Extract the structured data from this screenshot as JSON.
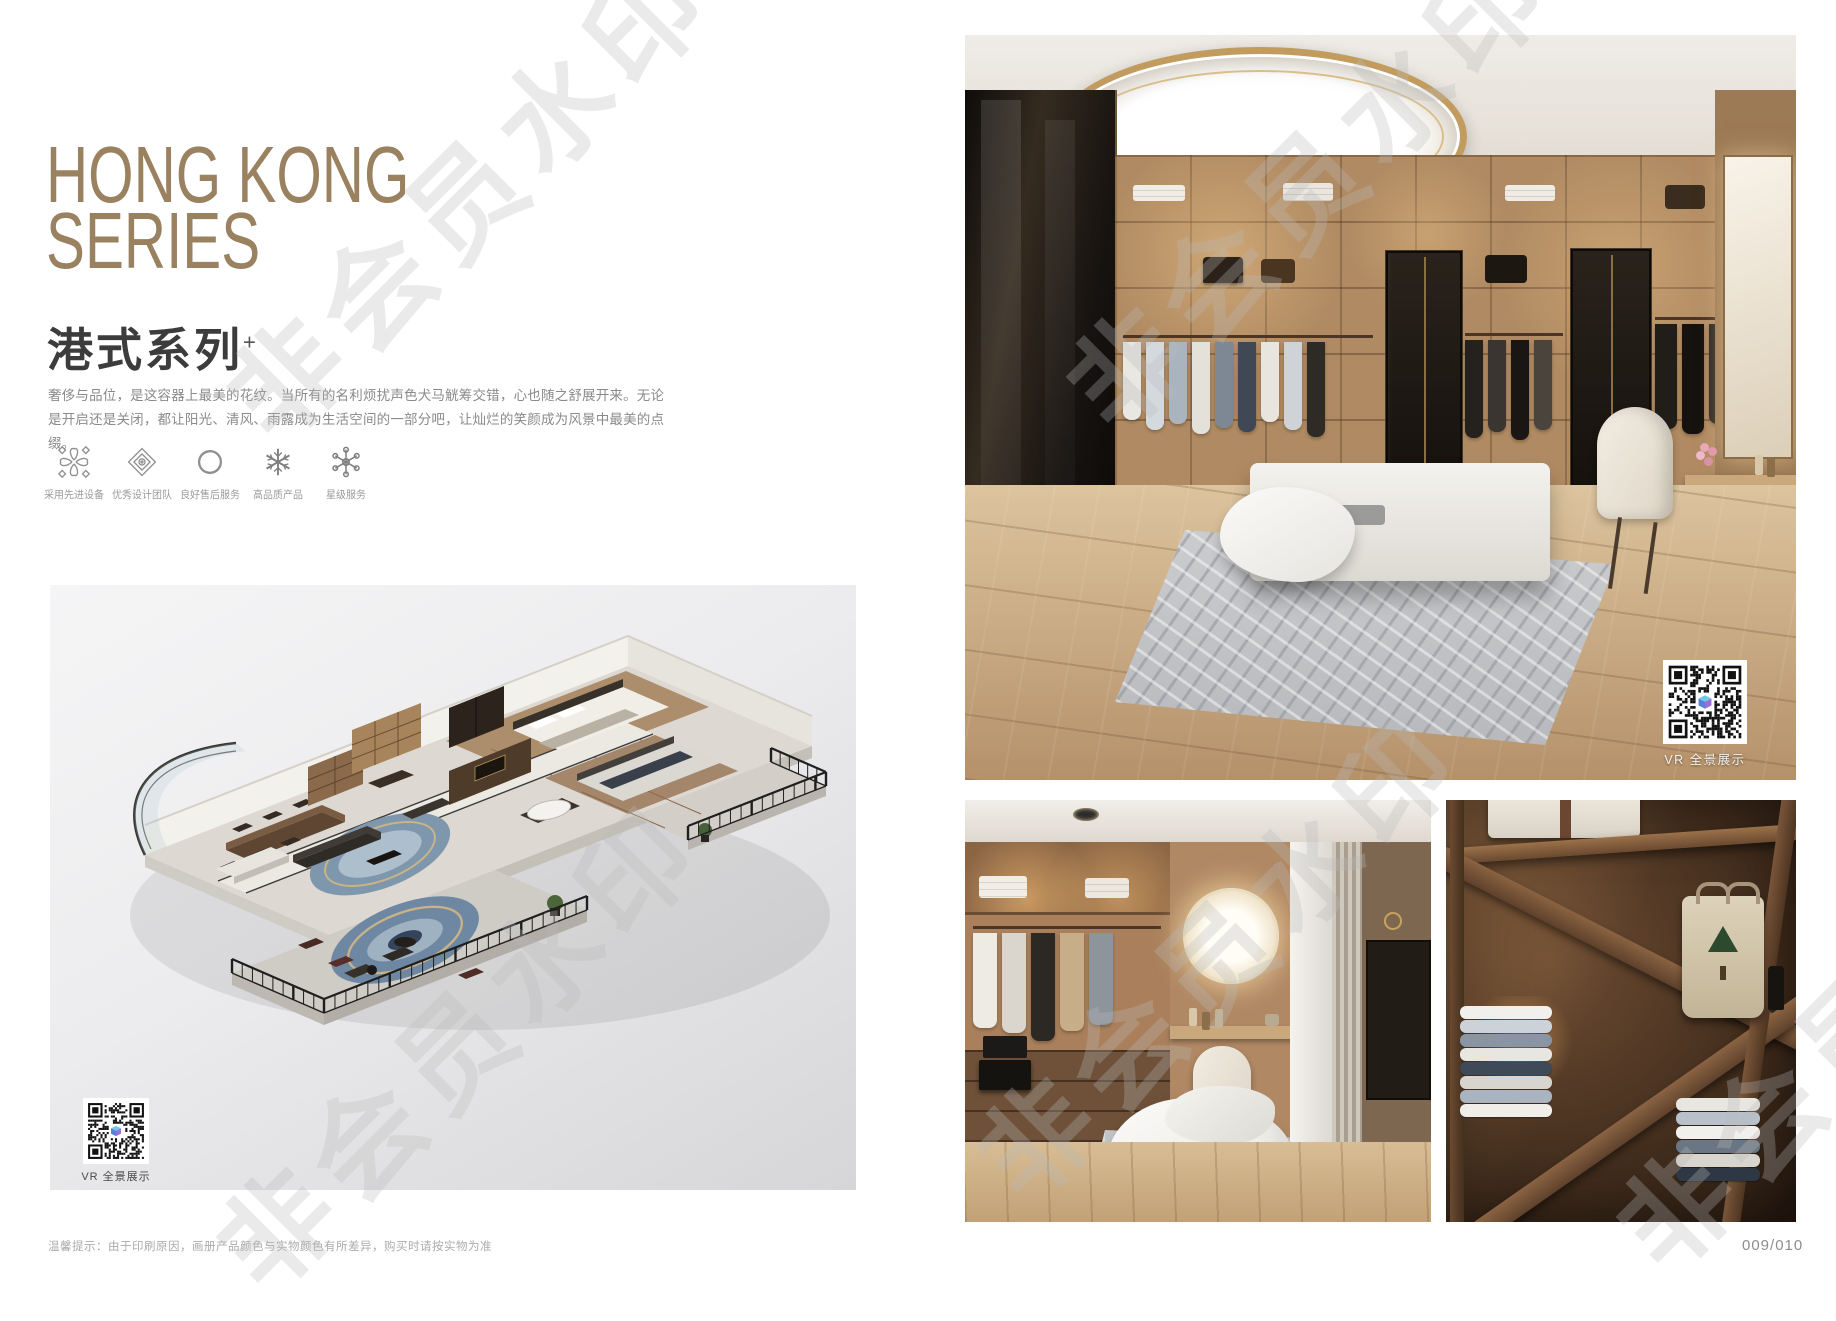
{
  "watermark": {
    "text": "非会员水印"
  },
  "left_page": {
    "title_line1": "HONG KONG",
    "title_line2": "SERIES",
    "subtitle": "港式系列",
    "subtitle_mark": "+",
    "description": "奢侈与品位，是这容器上最美的花纹。当所有的名利烦扰声色犬马觥筹交错，心也随之舒展开来。无论是开启还是关闭，都让阳光、清风、雨露成为生活空间的一部分吧，让灿烂的笑颜成为风景中最美的点缀。",
    "features": [
      {
        "icon": "pinwheel-icon",
        "label": "采用先进设备"
      },
      {
        "icon": "ornament-icon",
        "label": "优秀设计团队"
      },
      {
        "icon": "ring-icon",
        "label": "良好售后服务"
      },
      {
        "icon": "snowflake-icon",
        "label": "高品质产品"
      },
      {
        "icon": "star-service-icon",
        "label": "星级服务"
      }
    ],
    "floorplan_vr_label": "VR 全景展示",
    "disclaimer": "温馨提示：由于印刷原因，画册产品颜色与实物颜色有所差异，购买时请按实物为准"
  },
  "right_page": {
    "photo_vr_label": "VR 全景展示",
    "page_number": "009/010"
  },
  "colors": {
    "title_accent": "#9a8261",
    "subtitle_text": "#3c3c3c",
    "body_text": "#8a8a8a",
    "watermark": "#bbbbbb"
  }
}
